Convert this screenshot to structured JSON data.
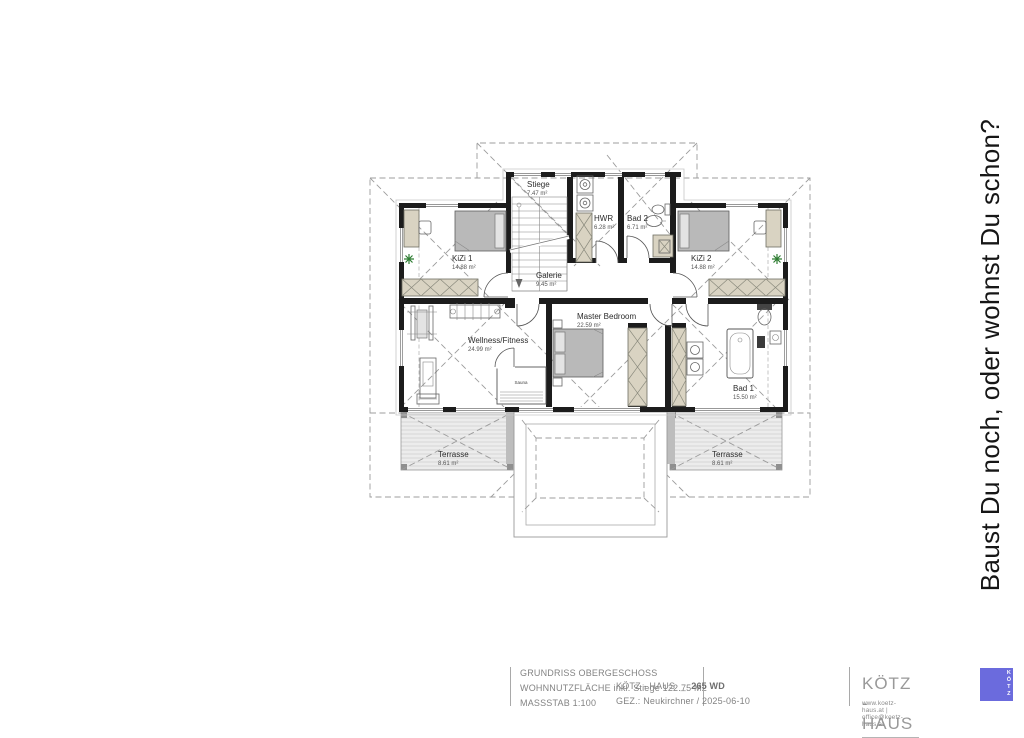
{
  "slogan": "Baust Du noch, oder wohnst Du schon?",
  "rooms": {
    "stiege": {
      "name": "Stiege",
      "area": "7.47 m²"
    },
    "hwr": {
      "name": "HWR",
      "area": "6.28 m²"
    },
    "bad2": {
      "name": "Bad 2",
      "area": "6.71 m²"
    },
    "kizi1": {
      "name": "KiZi 1",
      "area": "14.88 m²"
    },
    "kizi2": {
      "name": "KiZi 2",
      "area": "14.88 m²"
    },
    "galerie": {
      "name": "Galerie",
      "area": "9.45 m²"
    },
    "master": {
      "name": "Master Bedroom",
      "area": "22.59 m²"
    },
    "wellness": {
      "name": "Wellness/Fitness",
      "area": "24.99 m²"
    },
    "sauna": {
      "name": "Sauna"
    },
    "bad1": {
      "name": "Bad 1",
      "area": "15.50 m²"
    },
    "terrasse_left": {
      "name": "Terrasse",
      "area": "8.61 m²"
    },
    "terrasse_right": {
      "name": "Terrasse",
      "area": "8.61 m²"
    }
  },
  "title_block": {
    "drawing_title": "GRUNDRISS OBERGESCHOSS",
    "area_line": "WOHNNUTZFLÄCHE inkl. Stiege 122.75 M2",
    "scale_line": "MASSSTAB 1:100",
    "project_name": "KÖTZ - HAUS",
    "project_sep": "_",
    "project_code": "265 WD",
    "drawn_line": "GEZ.: Neukirchner / 2025-06-10",
    "brand": "KÖTZ - HAUS",
    "contact": "www.koetz-haus.at | office@koetz-haus.at",
    "logo_letters": "KÖTZ",
    "logo_color": "#6b6bdd"
  }
}
